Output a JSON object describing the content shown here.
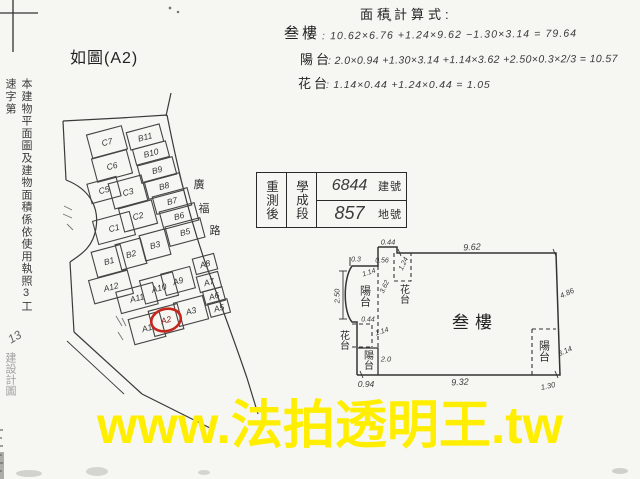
{
  "caption": {
    "text": "如圖(A2)"
  },
  "margin_note": {
    "printed": "本建物平面圖及建物面積係依使用執照3工速字第",
    "handwritten": "13",
    "printed_faint": "建設計圖"
  },
  "formulas": {
    "title": "面積計算式:",
    "rows": [
      {
        "label": "叁樓",
        "expr": ": 10.62×6.76 +1.24×9.62 −1.30×3.14 = 79.64"
      },
      {
        "label": "陽台",
        "expr": ": 2.0×0.94 +1.30×3.14 +1.14×3.62 +2.50×0.3×2/3 = 10.57"
      },
      {
        "label": "花台",
        "expr": ": 1.14×0.44 +1.24×0.44 = 1.05"
      }
    ]
  },
  "survey_table": {
    "row_header": "重測後",
    "section_name": "學成段",
    "building_no": "6844",
    "building_no_label": "建號",
    "land_no": "857",
    "land_no_label": "地號"
  },
  "site_map": {
    "road_name": "廣福路",
    "road_chars": [
      "廣",
      "福",
      "路"
    ],
    "plots": [
      "C7",
      "C6",
      "C5",
      "C3",
      "C2",
      "C1",
      "B11",
      "B10",
      "B9",
      "B8",
      "B7",
      "B6",
      "B5",
      "B3",
      "B2",
      "B1",
      "A12",
      "A11",
      "A10",
      "A9",
      "A8",
      "A7",
      "A6",
      "A5",
      "A1",
      "A2",
      "A3"
    ],
    "highlighted_plot": "A2",
    "highlight_color": "#c5271d"
  },
  "floor_plan": {
    "room_label": "叁樓",
    "balcony": "陽台",
    "flower_bed": "花台",
    "dims": {
      "top": "9.62",
      "bottom": "9.32",
      "right_upper": "4.86",
      "right_lower": "3.14",
      "left": "2.50",
      "top_step": "0.44",
      "left_step": "0.3",
      "step_width": "0.56",
      "flower_top_h": "1.24",
      "balcony_top_w": "1.14",
      "balcony_h": "3.62",
      "mid_step": "0.44",
      "flower_low_w": "1.14",
      "balcony_low_h": "2.0",
      "bottom_left": "0.94",
      "bottom_right": "1.30"
    }
  },
  "watermark": {
    "text": "www.法拍透明王.tw",
    "color": "#ffee00"
  }
}
